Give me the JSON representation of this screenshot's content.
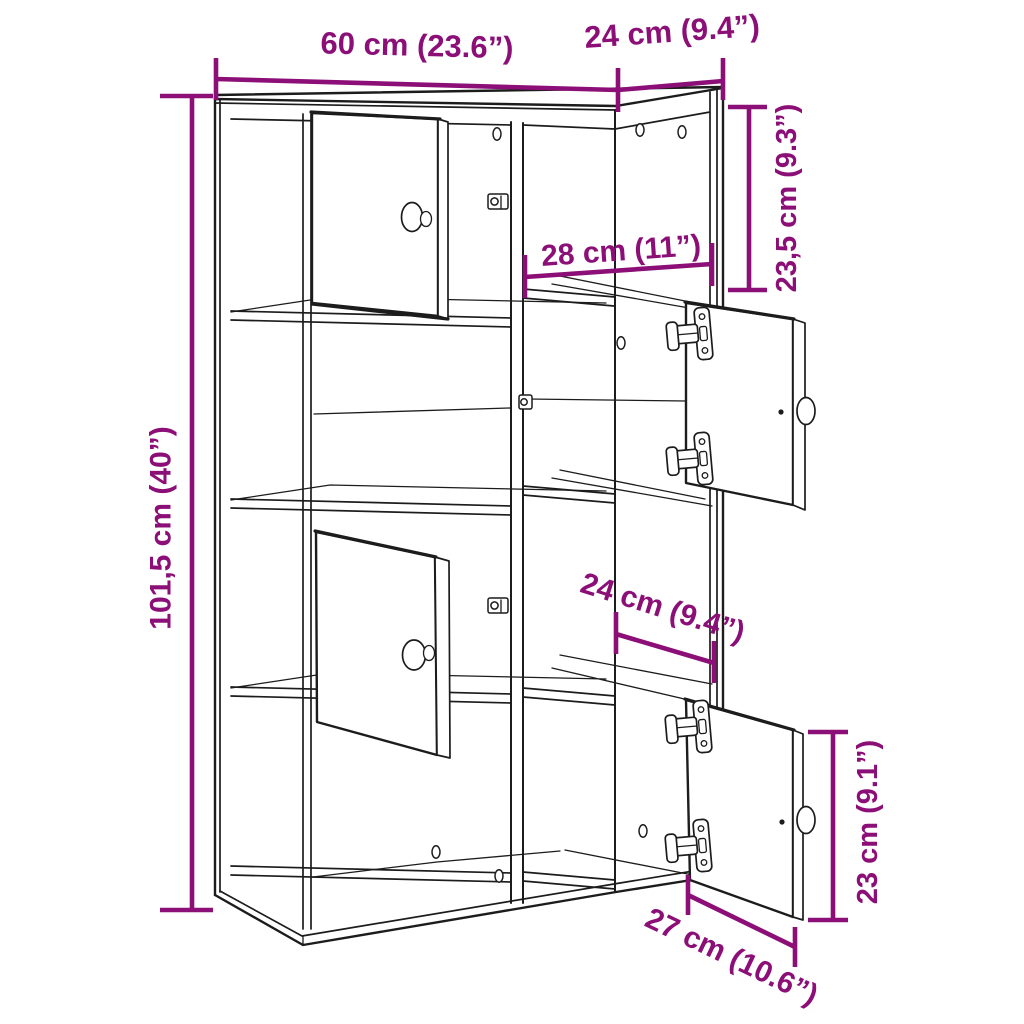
{
  "diagram": {
    "kind": "bookcase-dimension-diagram",
    "background_color": "#ffffff",
    "drawing_line_color": "#1c1c1c",
    "dimension_color": "#8C0F78"
  },
  "dimensions": {
    "width": "60 cm (23.6”)",
    "depth": "24 cm (9.4”)",
    "height": "101,5 cm (40”)",
    "top_compartment_height": "23,5 cm (9.3”)",
    "compartment_width": "28 cm (11”)",
    "compartment_depth": "24 cm (9.4”)",
    "door_height": "23 cm (9.1”)",
    "door_width": "27 cm (10.6”)"
  }
}
